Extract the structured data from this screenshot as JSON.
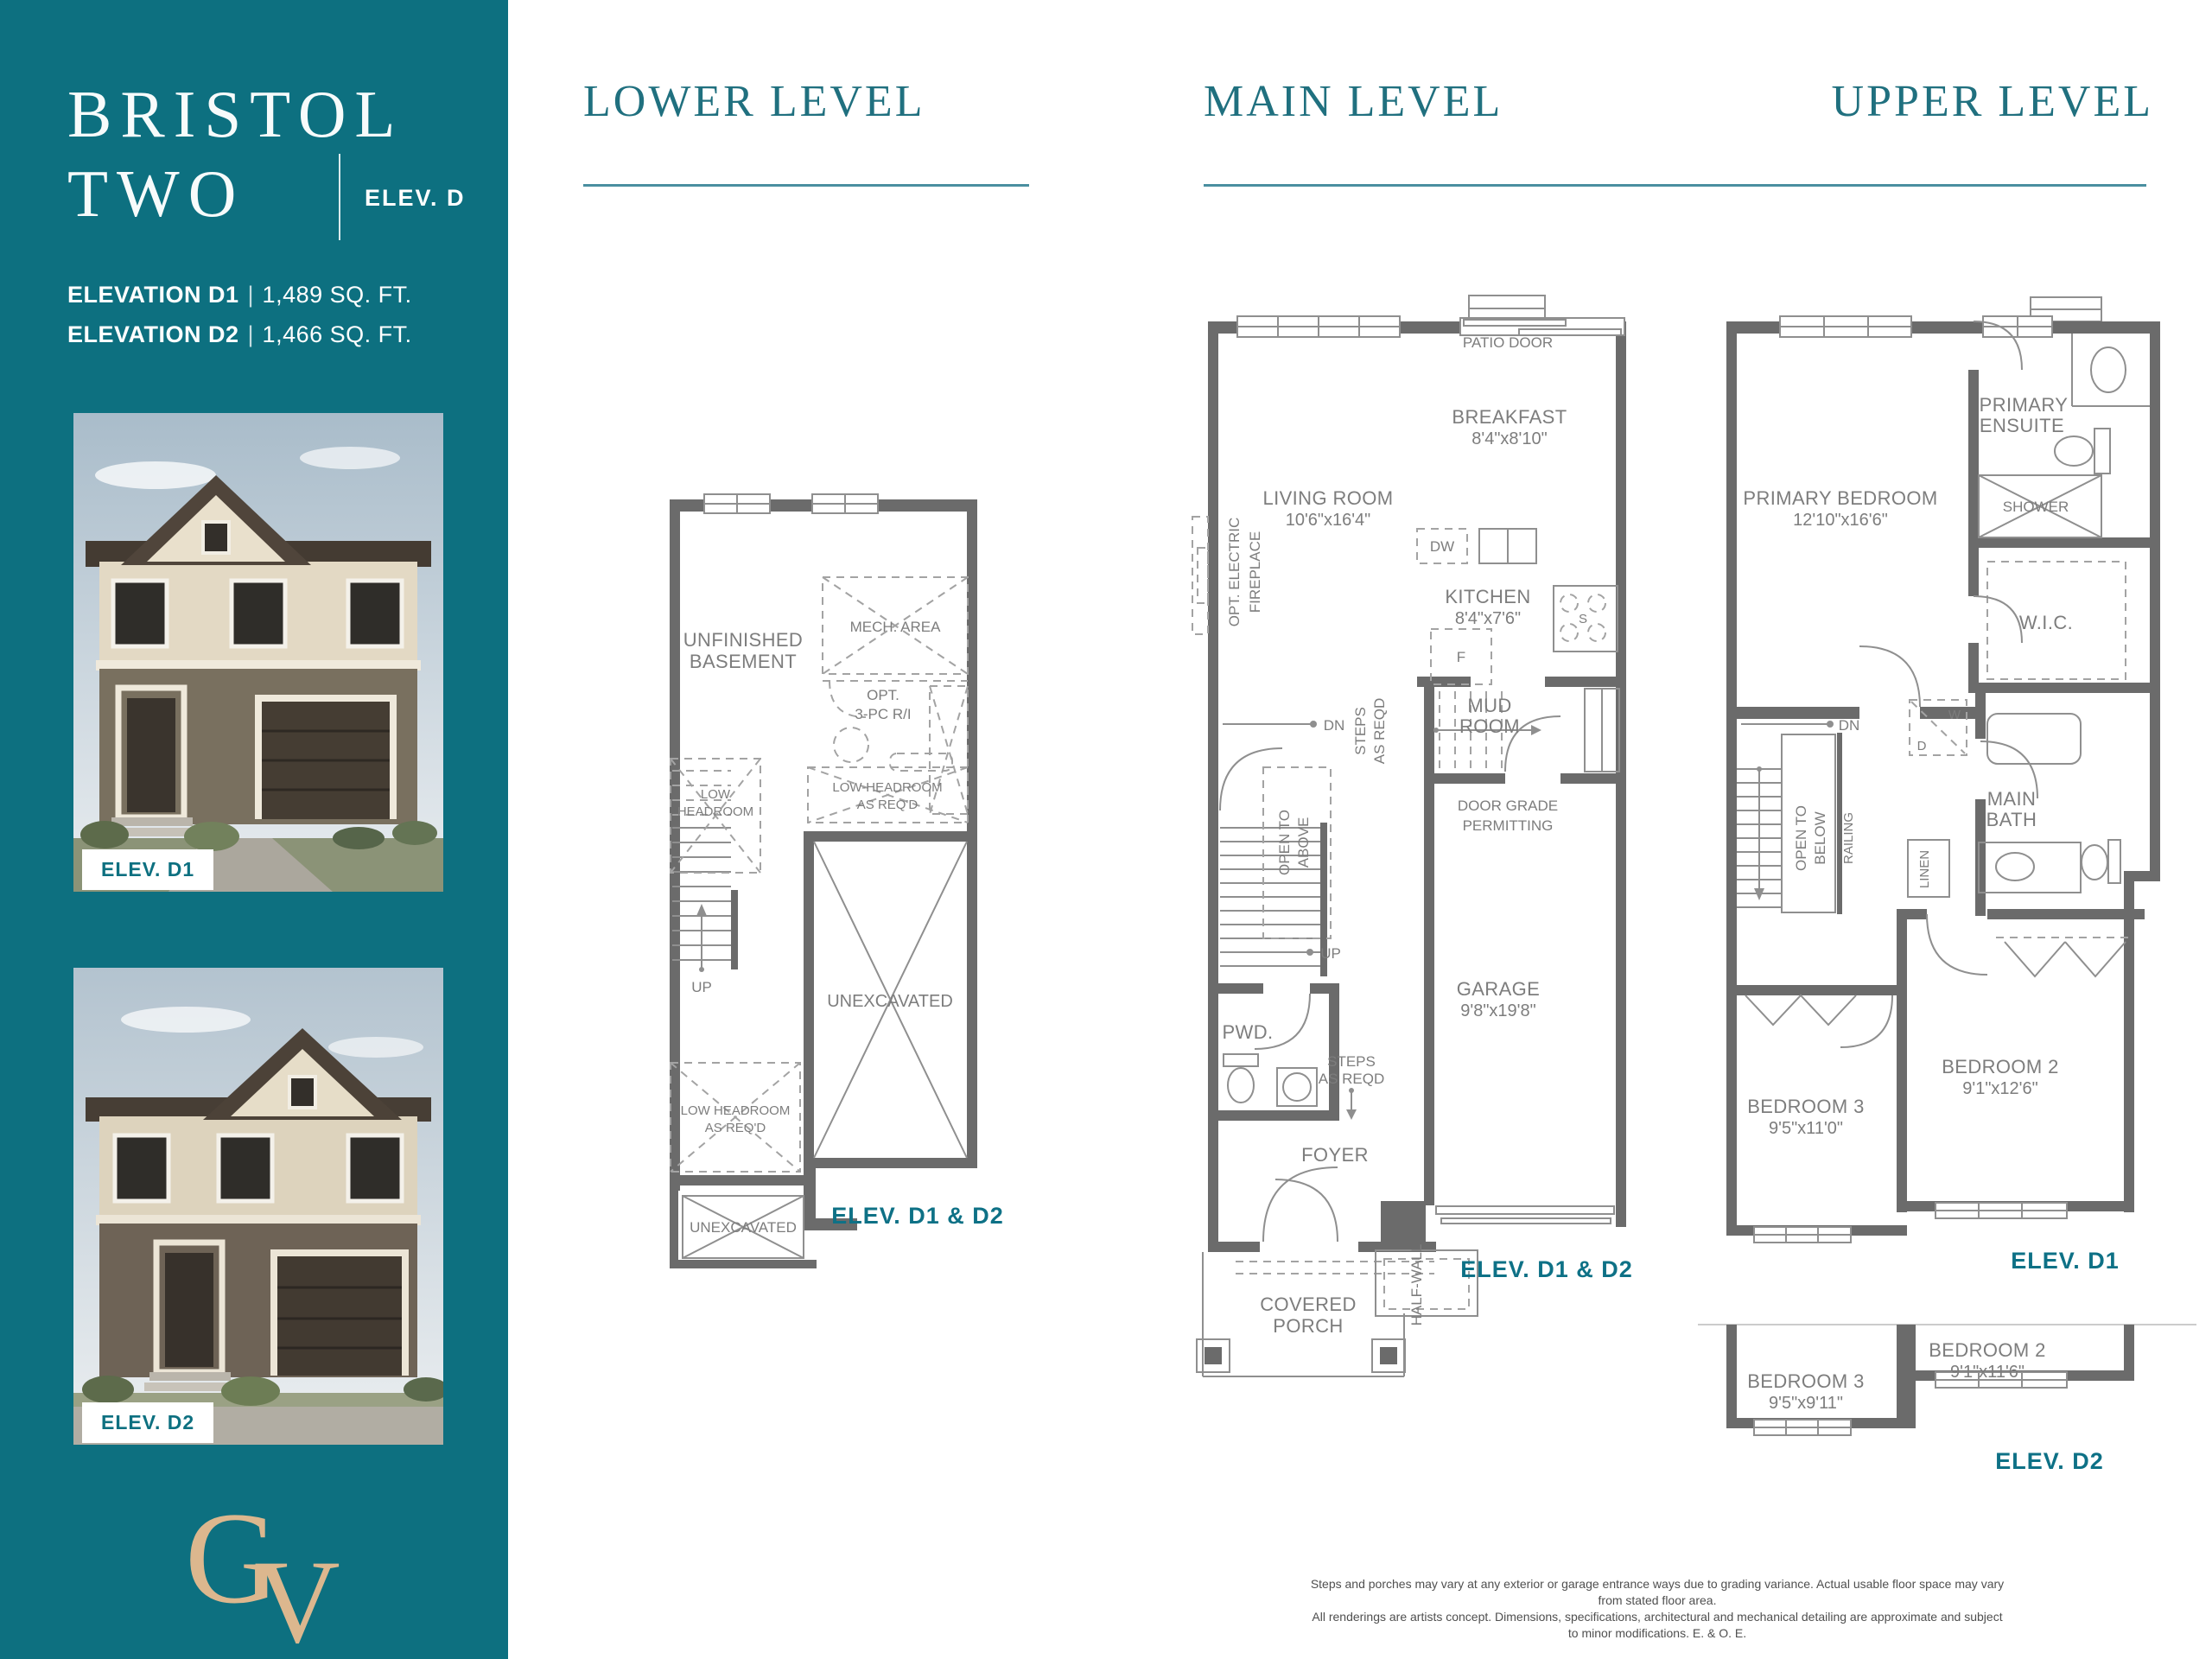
{
  "colors": {
    "sidebar_teal": "#0D7080",
    "heading_teal": "#20707F",
    "elev_note_teal": "#0E7186",
    "rule_teal": "#4A8FA0",
    "monogram_beige": "#DCB78E",
    "wall_gray": "#6B6B6B"
  },
  "sidebar": {
    "title_line1": "BRISTOL",
    "title_line2": "TWO",
    "elevation_tag": "ELEV. D",
    "specs": [
      {
        "label": "ELEVATION D1",
        "separator": "|",
        "value": "1,489 SQ. FT."
      },
      {
        "label": "ELEVATION D2",
        "separator": "|",
        "value": "1,466 SQ. FT."
      }
    ],
    "photo1_badge": "ELEV. D1",
    "photo2_badge": "ELEV. D2",
    "monogram_g": "G",
    "monogram_v": "V"
  },
  "headings": {
    "lower": "LOWER LEVEL",
    "main": "MAIN LEVEL",
    "upper": "UPPER LEVEL"
  },
  "lower_plan": {
    "unfinished_basement_l1": "UNFINISHED",
    "unfinished_basement_l2": "BASEMENT",
    "mech_area": "MECH. AREA",
    "opt_l1": "OPT.",
    "opt_l2": "3-PC R/I",
    "low_headroom_l1": "LOW",
    "low_headroom_l2": "HEADROOM",
    "low_headroom_right_l1": "LOW-HEADROOM",
    "low_headroom_right_l2": "AS REQ'D",
    "low_headroom_stair_l1": "LOW HEADROOM",
    "low_headroom_stair_l2": "AS REQ'D",
    "up": "UP",
    "unexcavated_main": "UNEXCAVATED",
    "unexcavated_small": "UNEXCAVATED",
    "elev_note": "ELEV. D1 & D2"
  },
  "main_plan": {
    "patio_door": "PATIO DOOR",
    "breakfast": "BREAKFAST",
    "breakfast_dims": "8'4\"x8'10\"",
    "living_room": "LIVING ROOM",
    "living_room_dims": "10'6\"x16'4\"",
    "fireplace_l1": "OPT. ELECTRIC",
    "fireplace_l2": "FIREPLACE",
    "dw": "DW",
    "kitchen": "KITCHEN",
    "kitchen_dims": "8'4\"x7'6\"",
    "s": "S",
    "f": "F",
    "dn": "DN",
    "steps_req_v_l1": "STEPS",
    "steps_req_v_l2": "AS REQD",
    "mud_room_l1": "MUD",
    "mud_room_l2": "ROOM",
    "door_grade_l1": "DOOR GRADE",
    "door_grade_l2": "PERMITTING",
    "open_above_l1": "OPEN TO",
    "open_above_l2": "ABOVE",
    "up": "UP",
    "pwd": "PWD.",
    "garage": "GARAGE",
    "garage_dims": "9'8\"x19'8\"",
    "steps_req_l1": "STEPS",
    "steps_req_l2": "AS REQD",
    "foyer": "FOYER",
    "covered_porch_l1": "COVERED",
    "covered_porch_l2": "PORCH",
    "half_wall": "HALF-WALL",
    "elev_note": "ELEV. D1 & D2"
  },
  "upper_plan": {
    "primary_bedroom": "PRIMARY BEDROOM",
    "primary_bedroom_dims": "12'10\"x16'6\"",
    "primary_ensuite_l1": "PRIMARY",
    "primary_ensuite_l2": "ENSUITE",
    "shower": "SHOWER",
    "wic": "W.I.C.",
    "dn": "DN",
    "w": "W",
    "d": "D",
    "main_bath_l1": "MAIN",
    "main_bath_l2": "BATH",
    "open_below_l1": "OPEN TO",
    "open_below_l2": "BELOW",
    "railing": "RAILING",
    "linen": "LINEN",
    "bedroom3": "BEDROOM 3",
    "bedroom3_dims": "9'5\"x11'0\"",
    "bedroom2": "BEDROOM 2",
    "bedroom2_dims": "9'1\"x12'6\"",
    "elev_note": "ELEV. D1",
    "d2": {
      "bedroom3": "BEDROOM 3",
      "bedroom3_dims": "9'5\"x9'11\"",
      "bedroom2": "BEDROOM 2",
      "bedroom2_dims": "9'1\"x11'6\"",
      "elev_note": "ELEV. D2"
    }
  },
  "footer": {
    "disclaimer_l1": "Steps and porches may vary at any exterior or garage entrance ways due to grading variance. Actual usable floor space may vary from stated floor area.",
    "disclaimer_l2": "All renderings are artists concept. Dimensions, specifications, architectural and mechanical detailing are approximate and subject to minor modifications. E. & O. E."
  }
}
